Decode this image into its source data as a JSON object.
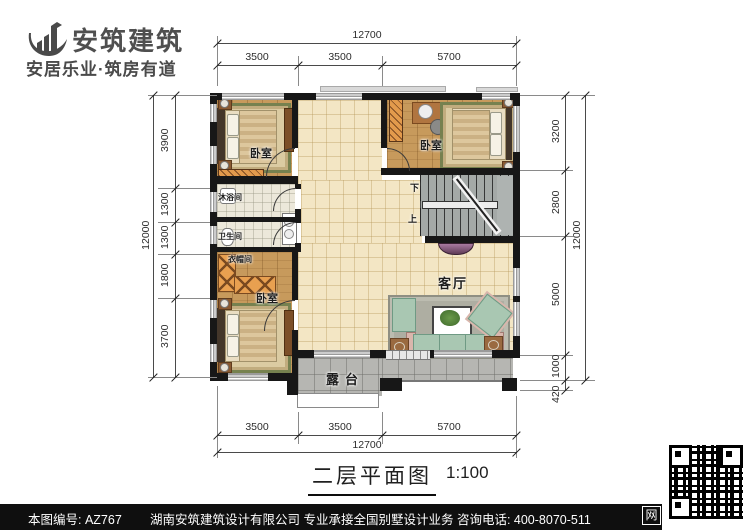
{
  "brand": {
    "name": "安筑建筑",
    "tagline": "安居乐业·筑房有道"
  },
  "plan": {
    "rooms": {
      "bedroom_tl": "卧室",
      "bedroom_tr": "卧室",
      "bedroom_bl": "卧室",
      "shower": "沐浴间",
      "toilet": "卫生间",
      "cloakroom": "衣帽间",
      "living": "客厅",
      "terrace": "露台"
    },
    "stairs": {
      "down": "下",
      "up": "上"
    },
    "watermark": "安筑建筑"
  },
  "dimensions": {
    "top": {
      "total": "12700",
      "segments": [
        "3500",
        "3500",
        "5700"
      ]
    },
    "bottom": {
      "total": "12700",
      "segments": [
        "3500",
        "3500",
        "5700"
      ]
    },
    "left": {
      "total": "12000",
      "segments": [
        "3900",
        "1300",
        "1300",
        "1800",
        "3700"
      ]
    },
    "right": {
      "total": "12000",
      "segments": [
        "3200",
        "2800",
        "5000",
        "1000",
        "420"
      ]
    }
  },
  "title": {
    "name": "二层平面图",
    "scale": "1:100"
  },
  "footer": {
    "drawing_no": "本图编号: AZ767",
    "company": "湖南安筑建筑设计有限公司  专业承接全国别墅设计业务  咨询电话: 400-8070-511",
    "web_label": "网"
  },
  "colors": {
    "wall": "#171717",
    "floor_tile": "#f3e6c4",
    "wood_floor": "#c79a5c",
    "terrace": "#b6b6b2",
    "rug_border": "#76814f",
    "footer_bg": "#0f0f0f"
  }
}
